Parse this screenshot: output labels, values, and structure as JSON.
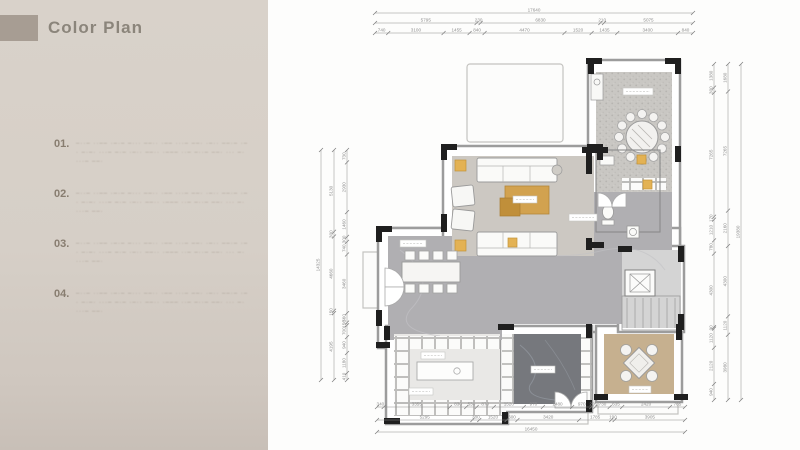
{
  "panel": {
    "title": "Color Plan",
    "accent_color": "#a79d93",
    "background": "#d7d0c8",
    "items": [
      {
        "num": "01.",
        "lines": [
          "–··– ··–– ·–·– –··· ––·· ·–– ···– ––· ·–·· ––·– ·–",
          "· –·–· ···– –·– ·–·· ––·· ·––– ··– –··– ––· ··· –·",
          "···– ––·"
        ]
      },
      {
        "num": "02.",
        "lines": [
          "–··– ··–– ·–·– –··· ––·· ·–– ···– ––· ·–·· ––·– ·–",
          "· –·–· ···– –·– ·–·· ––·· ·––– ··– –··– ––· ··· –·",
          "···– ––·"
        ]
      },
      {
        "num": "03.",
        "lines": [
          "–··– ··–– ·–·– –··· ––·· ·–– ···– ––· ·–·· ––·– ·–",
          "· –·–· ···– –·– ·–·· ––·· ·––– ··– –··– ––· ··· –·",
          "···– ––·"
        ]
      },
      {
        "num": "04.",
        "lines": [
          "–··– ··–– ·–·– –··· ––·· ·–– ···– ––· ·–·· ––·– ·–",
          "· –·–· ···– –·– ·–·· ––·· ·––– ··– –··– ––· ··· –·",
          "···– ––·"
        ]
      }
    ]
  },
  "floor_plan": {
    "dimensions": {
      "top": [
        [
          "17640"
        ],
        [
          "5795",
          "230",
          "6830",
          "210",
          "5075"
        ],
        [
          "740",
          "3100",
          "1455",
          "840",
          "4470",
          "1520",
          "1435",
          "3400",
          "840"
        ]
      ],
      "bottom": [
        [
          "340",
          "3355",
          "830",
          "530",
          "870",
          "1520",
          "970",
          "1480",
          "970",
          "205",
          "730",
          "635",
          "2420",
          "765"
        ],
        [
          "5295",
          "380",
          "1520",
          "600",
          "3420",
          "1785",
          "190",
          "3905"
        ],
        [
          "16450"
        ]
      ],
      "left": [
        [
          "14325"
        ],
        [
          "5130",
          "300",
          "4660",
          "150",
          "4195"
        ],
        [
          "730",
          "2930",
          "1460",
          "300",
          "740",
          "3460",
          "560",
          "150",
          "700",
          "940",
          "1180",
          "410"
        ]
      ],
      "right": [
        [
          "1380",
          "300",
          "7265",
          "170",
          "1210",
          "780",
          "4300",
          "90",
          "1120",
          "2120",
          "940"
        ],
        [
          "1680",
          "7265",
          "2160",
          "4300",
          "1120",
          "3980"
        ],
        [
          "19380"
        ]
      ]
    },
    "colors": {
      "marble": "#b0afb2",
      "living_floor": "#ccc8c2",
      "dining_texture": "#c9c7c3",
      "dark_floor": "#76787d",
      "wood_floor": "#c6b08f",
      "gold": "#d2a24f",
      "wall_accent": "#1f1f1f"
    }
  }
}
